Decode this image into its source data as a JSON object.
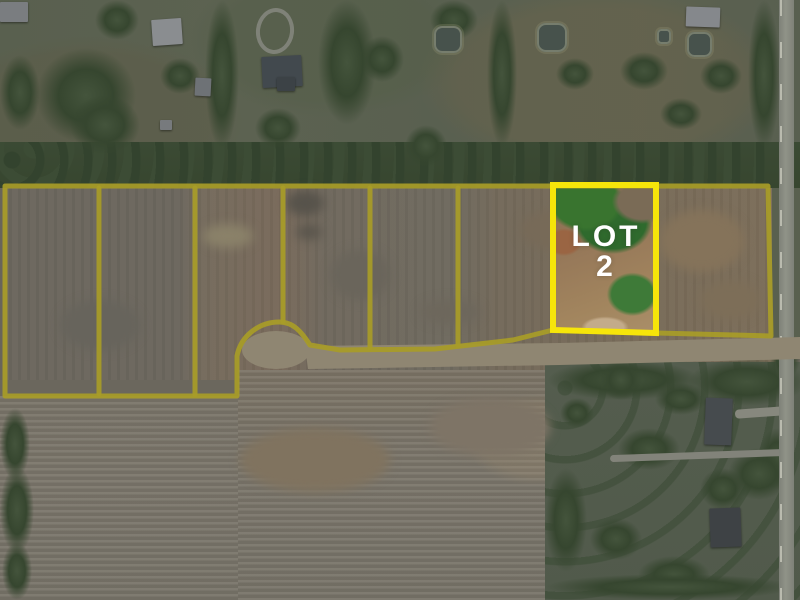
{
  "scene": {
    "kind": "aerial-lot-plat-photo",
    "highlighted_lot_name": "Lot 2"
  },
  "lot": {
    "label_line1": "LOT",
    "label_line2": "2"
  },
  "colors": {
    "boundary_line": "#a89c28",
    "highlight_border": "#f6e50a",
    "label_text": "#ffffff",
    "road_fill": "#8f8672"
  },
  "overlay": {
    "stroke_width_boundary": 5,
    "stroke_width_highlight": 6,
    "roads": [
      {
        "name": "culdesac-pavement",
        "type": "ellipse",
        "cx": 276,
        "cy": 350,
        "rx": 34,
        "ry": 19
      },
      {
        "name": "street-pavement",
        "type": "path",
        "d": "M305 346 L560 343 L800 337 L800 359 L560 365 L308 369 Z"
      }
    ],
    "boundary_paths": [
      {
        "name": "plat-outline",
        "d": "M5 186 L768 186 L771 336 L657 333 L553 330 L513 340 L435 349 L340 350 L310 345 C301 331 293 322 279 322 C260 322 241 335 237 356 L237 396 L5 396 Z"
      },
      {
        "name": "lot-divider-1",
        "d": "M99 188 L99 394"
      },
      {
        "name": "lot-divider-2",
        "d": "M195 188 L195 395"
      },
      {
        "name": "lot-divider-3",
        "d": "M283 188 L283 322"
      },
      {
        "name": "lot-divider-4",
        "d": "M370 188 L370 348"
      },
      {
        "name": "lot-divider-5",
        "d": "M458 188 L458 346"
      }
    ],
    "highlight_path": {
      "name": "lot-2-boundary",
      "d": "M553 185 L656 185 L656 333 L553 330 Z"
    }
  }
}
